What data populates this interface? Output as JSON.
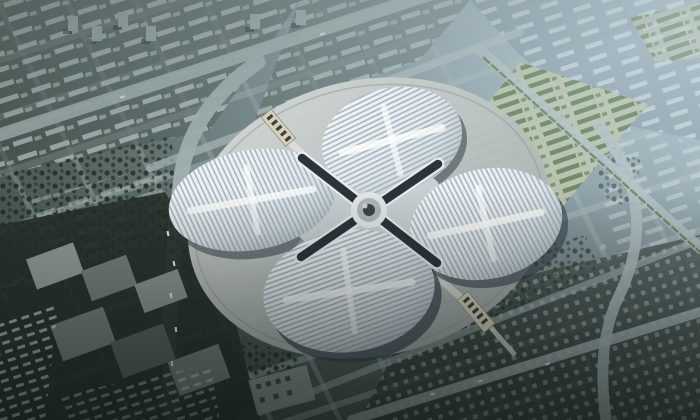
{
  "meta": {
    "title": "Aerial rendering of a four-petal clover-shaped exhibition complex surrounded by a city grid",
    "description": "Bird's-eye architectural visualization: four white ribbed roof petals joined by a dark X-shaped valley cross around a circular central hub, raised plaza, pedestrian gate bridges northwest and southeast, hedge-row parking field to the northeast, slab-roof industrial buildings to the southwest, dense dark city blocks at bottom right, blue haze over the distant district at top right."
  },
  "scene": {
    "landmark": "clover-exhibition-center",
    "petal_count": "4",
    "features": "striped white petal roofs, dark X valley cross, circular hub, ring plaza, gate walkways",
    "surroundings": "diagonal avenue grid, tree blocks, parking lot with hedge rows, industrial slabs, hazy distant district"
  },
  "palette": {
    "haze_top": "#aec5d2",
    "city_light": "#7e9298",
    "city_mid": "#5d6e6b",
    "city_dark": "#333d38",
    "road_light": "#9fb0b1",
    "road_main": "#aab9ba",
    "building_row": "#b7c5c6",
    "building_row_haze": "#c6d6dc",
    "tree_dark": "#223024",
    "block_green": "#3c4c41",
    "roof_white": "#f5f8f9",
    "roof_base": "#ccd6db",
    "roof_stripe": "#8fa0ac",
    "roof_shadow": "#343e49",
    "connector_grey": "#c9d0d3",
    "hub_ring": "#aeb7bb",
    "hub_dark": "#1b232b",
    "plaza_light": "#d3d7d5",
    "plaza_dark": "#a3adac",
    "parking_ground": "#b2bd9e",
    "hedge_green": "#4e6b3c",
    "industrial_ground": "#27302b",
    "slab_light": "#9aa39c",
    "slab_mid": "#79847d",
    "slab_dark": "#5a655f",
    "gate_beige": "#d6d0ba",
    "walkway_grey": "#d9dcd8",
    "car_white": "#e9eef0",
    "dots_building": "#93a19c",
    "glass_blue": "#9fb0bc",
    "vignette": "#0f1714",
    "haze_overlay": "#d2e2ea",
    "tower_grey": "#a7b8bb",
    "pavilion_grey": "#9aa29e"
  }
}
